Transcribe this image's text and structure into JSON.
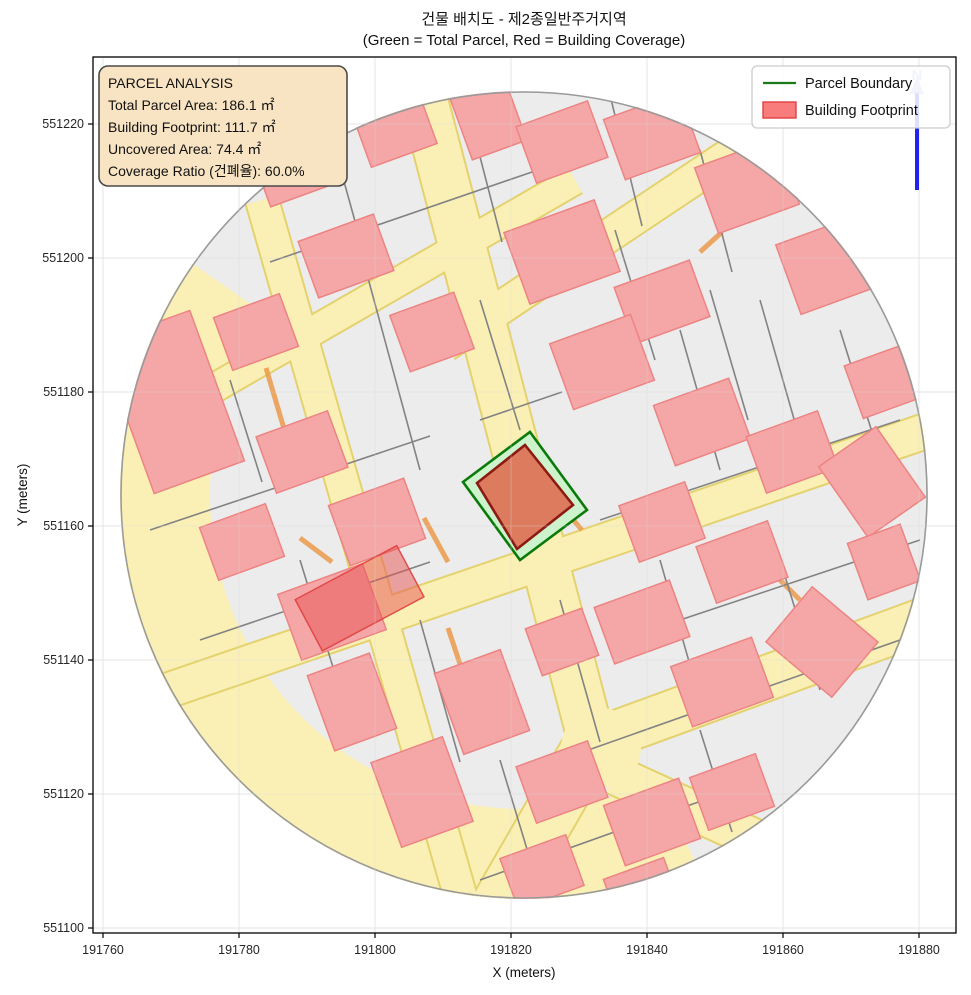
{
  "title": {
    "line1": "건물 배치도 - 제2종일반주거지역",
    "line2": "(Green = Total Parcel, Red = Building Coverage)"
  },
  "info_box": {
    "title": "PARCEL ANALYSIS",
    "total_parcel_area": "Total Parcel Area: 186.1 ㎡",
    "building_footprint": "Building Footprint: 111.7 ㎡",
    "uncovered_area": "Uncovered Area: 74.4 ㎡",
    "coverage_ratio": "Coverage Ratio (건폐율): 60.0%"
  },
  "legend": {
    "parcel_boundary_label": "Parcel Boundary",
    "building_footprint_label": "Building Footprint"
  },
  "axes": {
    "x_label": "X (meters)",
    "y_label": "Y (meters)",
    "x_ticks": [
      "191760",
      "191780",
      "191800",
      "191820",
      "191840",
      "191860",
      "191880"
    ],
    "y_ticks": [
      "551220",
      "551200",
      "551180",
      "551160",
      "551140",
      "551120",
      "551100"
    ]
  },
  "north_arrow": {
    "label": "N"
  },
  "colors": {
    "road_fill": "#FAF0B5",
    "road_edge": "#E4D26E",
    "parcel_background": "#ECECEC",
    "parcel_line": "#838383",
    "building_fill": "#F5A6A6",
    "building_edge": "#ED8484",
    "highlight_parcel_fill": "#CCF3CC",
    "highlight_parcel_edge": "#0B7A0B",
    "highlight_building_fill": "#DD7B5F",
    "highlight_building_edge": "#8C1A12",
    "info_box_fill": "#F8E4C2",
    "north_arrow_blue": "#2222EE",
    "legend_line_green": "#1A7A1A",
    "legend_patch_red": "#F87C7C",
    "overlap_building_red": "#E85252"
  }
}
